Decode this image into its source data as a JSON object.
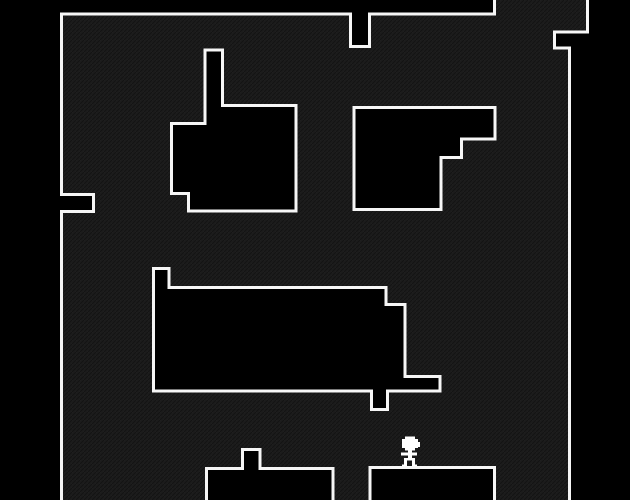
{
  "scene": {
    "width": 630,
    "height": 500,
    "palette": {
      "outside": "#000000",
      "room_fill": "#1c1c1c",
      "texture_line_dark": "#141414",
      "texture_line_light": "#242424",
      "wall_stroke": "#f6f6f6",
      "obstacle_fill": "#000000",
      "obstacle_stroke": "#f6f6f6",
      "player": "#ffffff"
    },
    "room": {
      "stroke_width": 3,
      "interior_path": "M 60,13 H 352 V 48 H 368 V 13 H 496 V 0 H 589 V 33 H 554 V 49 H 571 V 500 H 60 V 213 H 95 V 194 H 60 Z",
      "wall_paths": [
        {
          "name": "wall-top-and-left",
          "d": "M 494.5,0 V 14 H 369.5 V 46.5 H 350.5 V 14 H 61.5 V 194.5 H 93.5 V 211.5 H 61.5 V 500"
        },
        {
          "name": "wall-right",
          "d": "M 587.5,0 V 32 H 554.5 V 48 H 569.5 V 500"
        }
      ]
    },
    "obstacles": [
      {
        "name": "obstacle-top-left-block",
        "d": "M 205,50 H 222.5 V 105.5 H 296 V 211 H 188.5 V 193.5 H 171.5 V 123.5 H 205 Z"
      },
      {
        "name": "obstacle-top-right-block",
        "d": "M 354,107.5 H 495 V 139 H 461.5 V 157.5 H 441 V 209.5 H 354 Z"
      },
      {
        "name": "obstacle-middle-block",
        "d": "M 153.5,268.5 H 169 V 287.5 H 386 V 304.5 H 405 V 376.5 H 440 V 391 H 387.5 V 409.5 H 371.5 V 391 H 153.5 Z"
      },
      {
        "name": "obstacle-bottom-left-platform",
        "d": "M 206.5,502 V 468.5 H 242.5 V 449.5 H 260 V 468.5 H 333 V 502"
      },
      {
        "name": "obstacle-bottom-right-platform",
        "d": "M 370,502 V 467.5 H 494.5 V 502"
      }
    ],
    "player": {
      "name": "player-sprite",
      "standing_on": "obstacle-bottom-right-platform",
      "pixels": [
        [
          405,
          436.5,
          10,
          3
        ],
        [
          402,
          439,
          16,
          9
        ],
        [
          405,
          447.5,
          10,
          3
        ],
        [
          417,
          442,
          3,
          5
        ],
        [
          408,
          450,
          4,
          3
        ],
        [
          401,
          452.5,
          16,
          3
        ],
        [
          408,
          455,
          4,
          4
        ],
        [
          404,
          458,
          11,
          2.5
        ],
        [
          404,
          460,
          3,
          6
        ],
        [
          412,
          460,
          3,
          6
        ],
        [
          402,
          464.5,
          5,
          2
        ],
        [
          412,
          464.5,
          5,
          2
        ]
      ]
    }
  }
}
